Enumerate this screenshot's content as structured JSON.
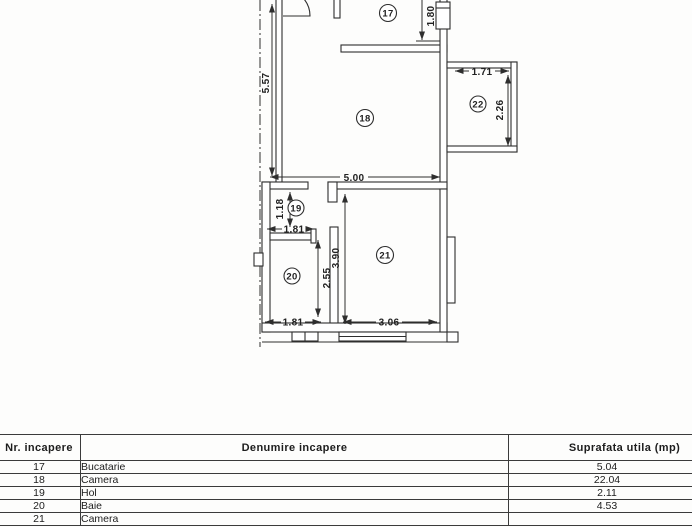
{
  "plan": {
    "rooms": {
      "r17": "17",
      "r18": "18",
      "r19": "19",
      "r20": "20",
      "r21": "21",
      "r22": "22"
    },
    "dims": {
      "d557": "5.57",
      "d180": "1.80",
      "d171": "1.71",
      "d226": "2.26",
      "d500": "5.00",
      "d118": "1.18",
      "d181a": "1.81",
      "d255": "2.55",
      "d390": "3.90",
      "d181b": "1.81",
      "d306": "3.06"
    }
  },
  "table": {
    "headers": {
      "nr": "Nr. incapere",
      "name": "Denumire incapere",
      "area": "Suprafata utila (mp)"
    },
    "rows": [
      {
        "nr": "17",
        "name": "Bucatarie",
        "area": "5.04"
      },
      {
        "nr": "18",
        "name": "Camera",
        "area": "22.04"
      },
      {
        "nr": "19",
        "name": "Hol",
        "area": "2.11"
      },
      {
        "nr": "20",
        "name": "Baie",
        "area": "4.53"
      },
      {
        "nr": "21",
        "name": "Camera",
        "area": ""
      }
    ]
  }
}
